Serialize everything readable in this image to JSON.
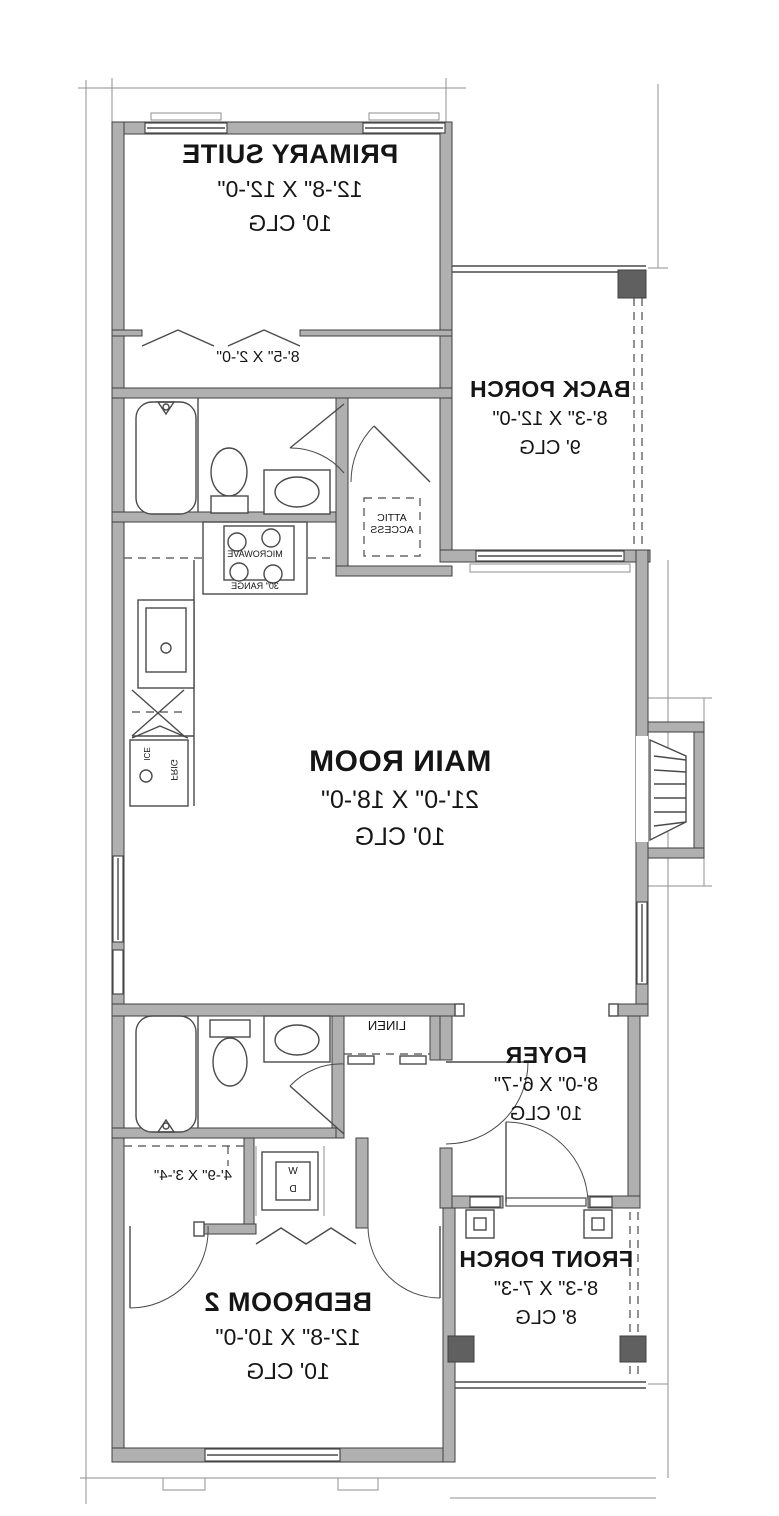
{
  "rooms": {
    "primary_suite": {
      "name": "PRIMARY SUITE",
      "dims": "12'-8\" X 12'-0\"",
      "ceiling": "10' CLG"
    },
    "back_porch": {
      "name": "BACK PORCH",
      "dims": "8'-3\" X 12'-0\"",
      "ceiling": "9' CLG"
    },
    "main_room": {
      "name": "MAIN ROOM",
      "dims": "21'-0\" X 18'-0\"",
      "ceiling": "10' CLG"
    },
    "foyer": {
      "name": "FOYER",
      "dims": "8'-0\" X 6'-7\"",
      "ceiling": "10' CLG"
    },
    "front_porch": {
      "name": "FRONT PORCH",
      "dims": "8'-3\" X 7'-3\"",
      "ceiling": "8' CLG"
    },
    "bedroom_2": {
      "name": "BEDROOM 2",
      "dims": "12'-8\" X 10'-0\"",
      "ceiling": "10' CLG"
    }
  },
  "closets": {
    "primary_closet_dims": "8'-5\" X 2'-0\"",
    "laundry_closet_dims": "4'-9\" X 3'-4\"",
    "linen_label": "LINEN",
    "attic_line1": "ATTIC",
    "attic_line2": "ACCESS"
  },
  "appliances": {
    "microwave_label": "MICROWAVE",
    "range_label": "30\" RANGE",
    "fridge_label": "FRIG",
    "ice_label": "ICE",
    "washer_label": "W",
    "dryer_label": "D"
  },
  "colors": {
    "wall_fill": "#b0b0b0",
    "wall_stroke": "#3f3f3f",
    "line": "#4a4a4a",
    "dim": "#8f8f8f",
    "post": "#606060",
    "text": "#151515",
    "bg": "#ffffff"
  }
}
